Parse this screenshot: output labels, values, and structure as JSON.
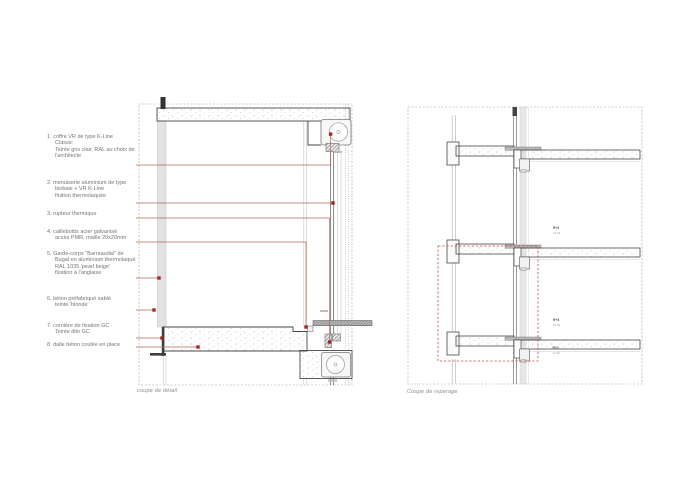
{
  "legend": {
    "items": [
      {
        "num": "1.",
        "lines": [
          "coffre VR de type K-Line",
          "Classic",
          "Teinte gris clair, RAL au choix de",
          "l'architecte"
        ]
      },
      {
        "num": "2.",
        "lines": [
          "menuiserie aluminium de type",
          "biobaie + VR K-Line",
          "finition thermolaquée"
        ]
      },
      {
        "num": "3.",
        "lines": [
          "rupteur thermique"
        ]
      },
      {
        "num": "4.",
        "lines": [
          "caillebottis acier galvanisé",
          "accès PMR, maille 20x20mm"
        ]
      },
      {
        "num": "5.",
        "lines": [
          "Garde-corps \"Barreaudal\" de",
          "Bugal en aluminium thermolaqué",
          "RAL 1035 'pearl beige'",
          "fixation à l'anglaise"
        ]
      },
      {
        "num": "6.",
        "lines": [
          "béton préfabriqué sablé",
          "teinte 'blonde'"
        ]
      },
      {
        "num": "7.",
        "lines": [
          "cornière de fixation GC",
          "Teinte dito GC"
        ]
      },
      {
        "num": "8.",
        "lines": [
          "dalle béton coulée en place"
        ]
      }
    ]
  },
  "captions": {
    "detail": "coupe de détail",
    "reperage": "Coupe de repérage"
  },
  "floor_labels": [
    {
      "name": "R+4",
      "level": "12.44"
    },
    {
      "name": "R+4",
      "level": "12.34"
    },
    {
      "name": "R+3",
      "level": "12.33"
    }
  ],
  "colors": {
    "leader_line": "#b5695a",
    "marker": "#a32622",
    "concrete_outline": "#474747",
    "panel_border": "#a0a0a0",
    "reperage_box": "#bf5449"
  }
}
